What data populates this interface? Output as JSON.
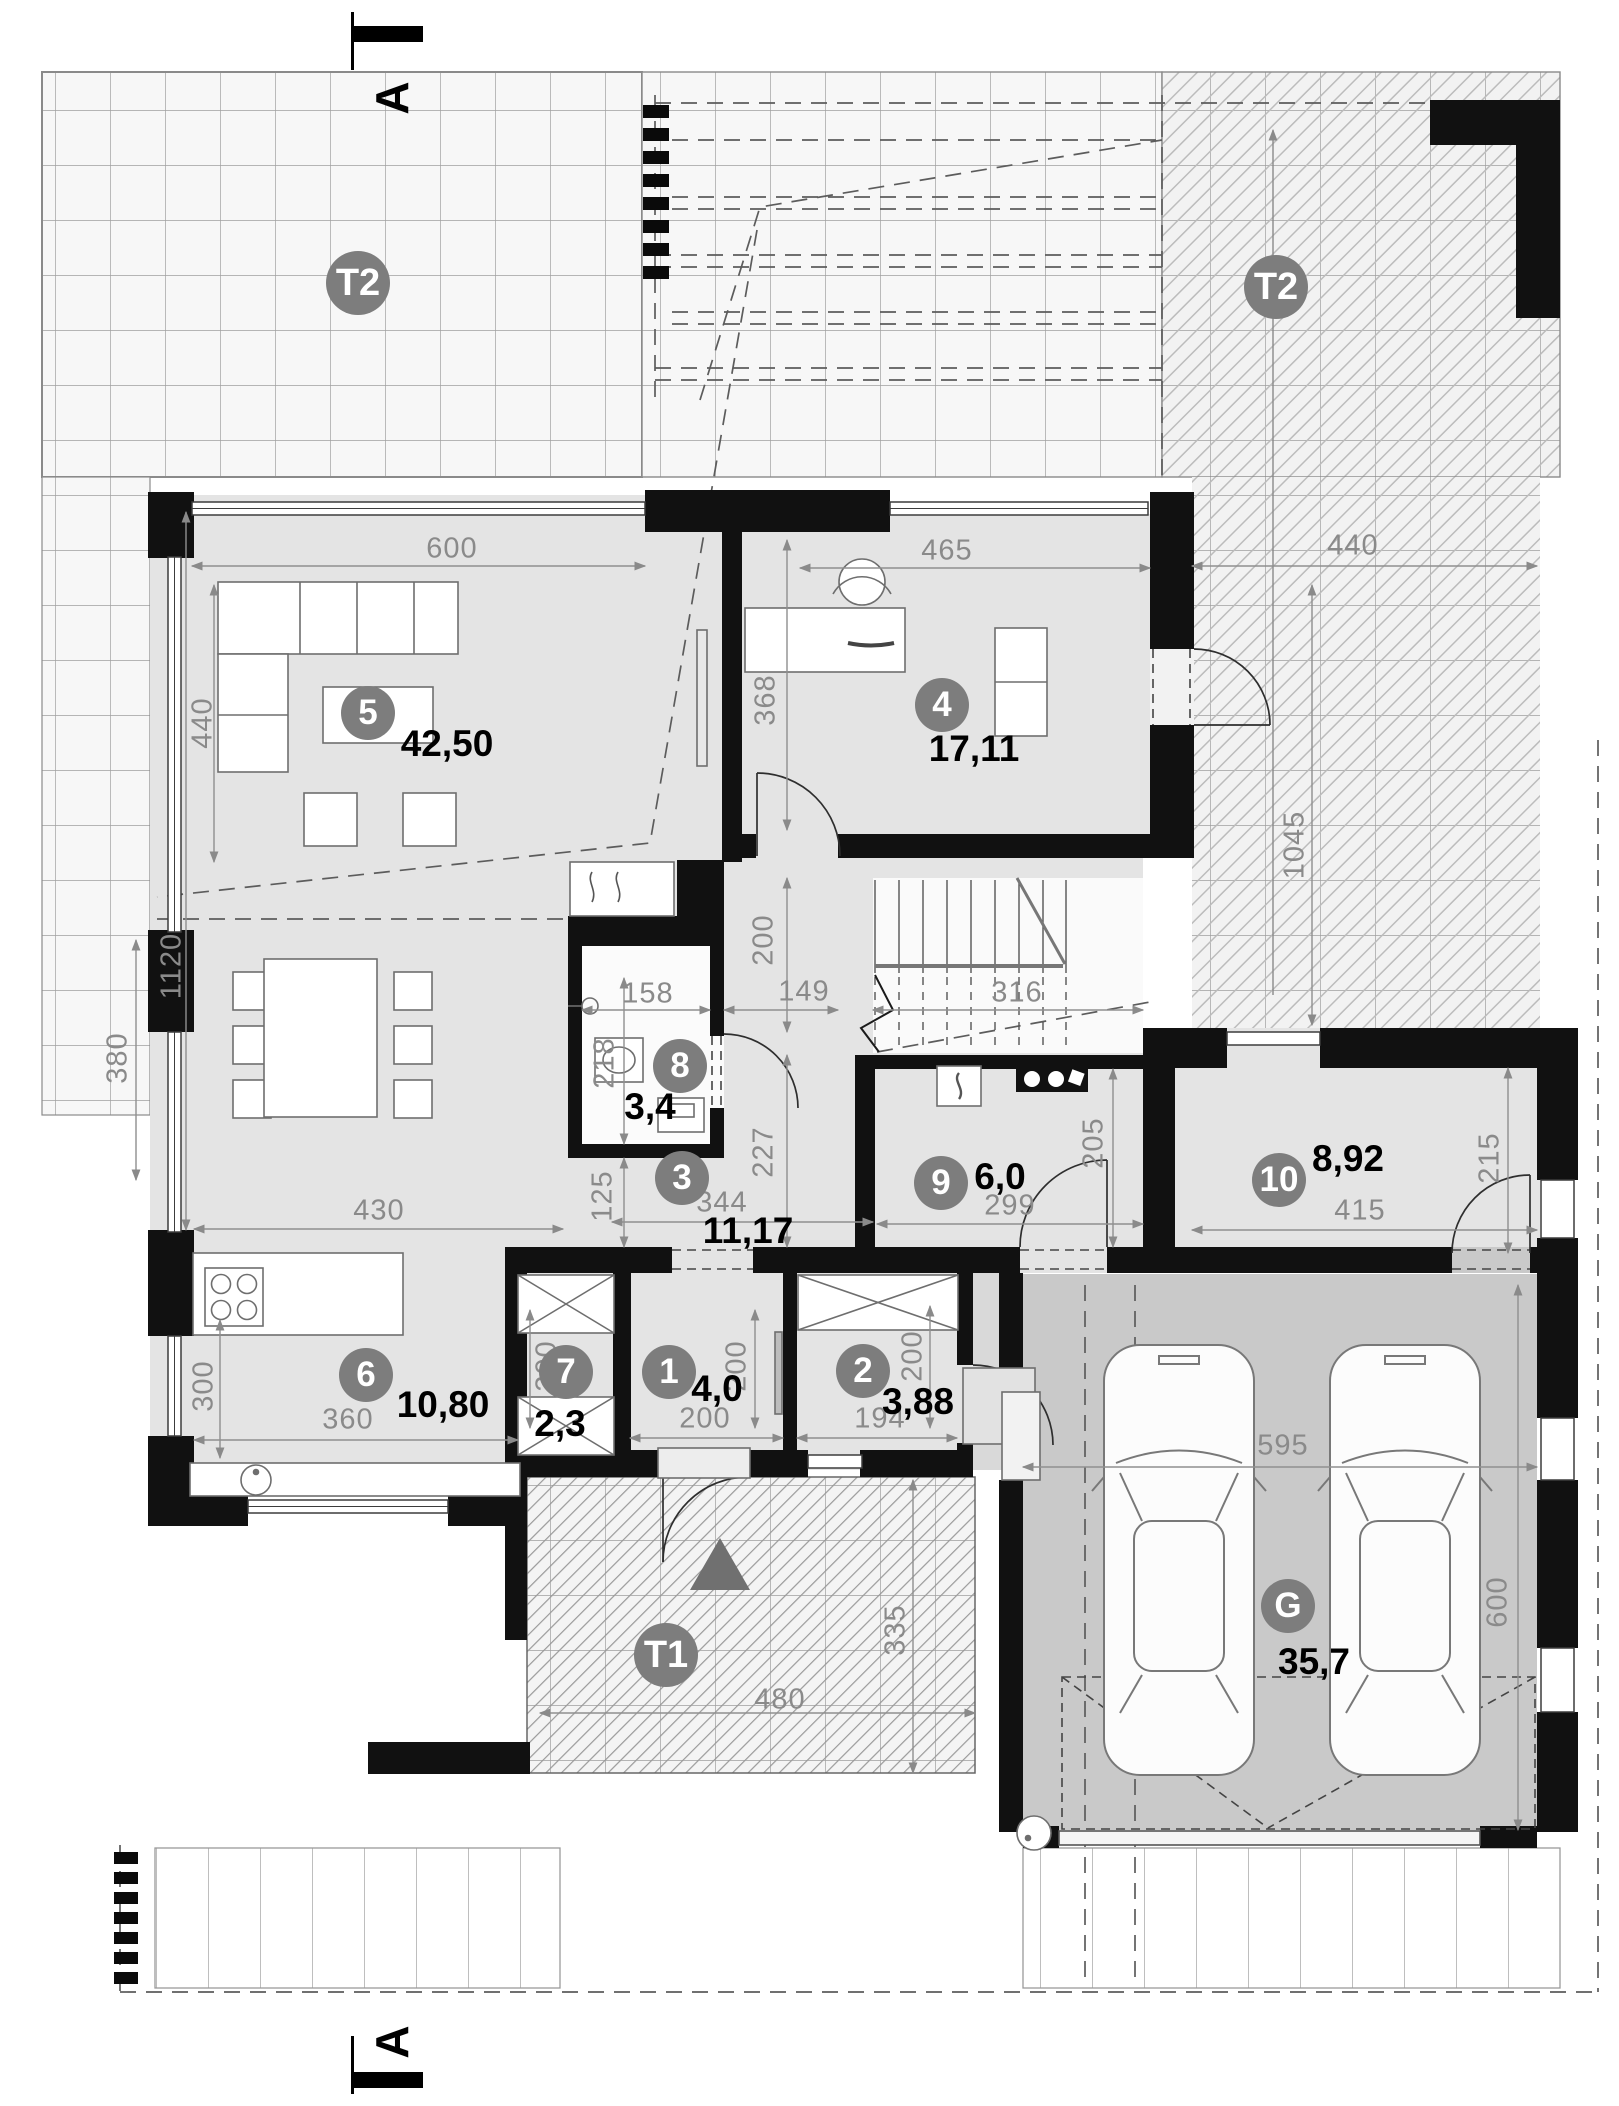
{
  "section_markers": {
    "top": "A",
    "bottom": "A"
  },
  "terraces": [
    {
      "badge": "T2"
    },
    {
      "badge": "T2"
    },
    {
      "badge": "T1"
    }
  ],
  "rooms": [
    {
      "badge": "5",
      "area": "42,50"
    },
    {
      "badge": "4",
      "area": "17,11"
    },
    {
      "badge": "8",
      "area": "3,4"
    },
    {
      "badge": "3",
      "area": "11,17"
    },
    {
      "badge": "9",
      "area": "6,0"
    },
    {
      "badge": "10",
      "area": "8,92"
    },
    {
      "badge": "6",
      "area": "10,80"
    },
    {
      "badge": "7",
      "area": "2,3"
    },
    {
      "badge": "1",
      "area": "4,0"
    },
    {
      "badge": "2",
      "area": "3,88"
    },
    {
      "badge": "G",
      "area": "35,7"
    }
  ],
  "dimensions": [
    {
      "v": "600"
    },
    {
      "v": "440"
    },
    {
      "v": "465"
    },
    {
      "v": "440"
    },
    {
      "v": "1045"
    },
    {
      "v": "368"
    },
    {
      "v": "1120"
    },
    {
      "v": "380"
    },
    {
      "v": "158"
    },
    {
      "v": "149"
    },
    {
      "v": "316"
    },
    {
      "v": "200"
    },
    {
      "v": "218"
    },
    {
      "v": "227"
    },
    {
      "v": "125"
    },
    {
      "v": "344"
    },
    {
      "v": "430"
    },
    {
      "v": "299"
    },
    {
      "v": "205"
    },
    {
      "v": "415"
    },
    {
      "v": "215"
    },
    {
      "v": "200"
    },
    {
      "v": "200"
    },
    {
      "v": "200"
    },
    {
      "v": "194"
    },
    {
      "v": "200"
    },
    {
      "v": "595"
    },
    {
      "v": "600"
    },
    {
      "v": "360"
    },
    {
      "v": "300"
    },
    {
      "v": "335"
    },
    {
      "v": "480"
    }
  ],
  "colors": {
    "badge": "#7d7d7d",
    "wall": "#111111",
    "room_floor": "#e4e4e4",
    "garage_floor": "#c9c9c9",
    "dim_text": "#8a8a8a"
  }
}
